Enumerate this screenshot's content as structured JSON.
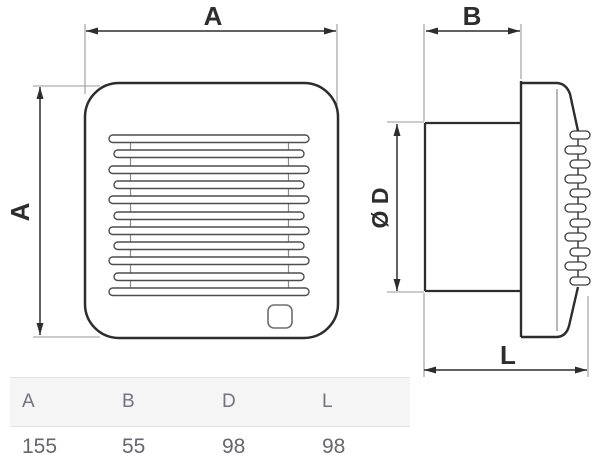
{
  "diagram": {
    "front_view": {
      "top_dim": "A",
      "left_dim": "A"
    },
    "side_view": {
      "top_dim": "B",
      "diameter_dim": "Ø D",
      "length_dim": "L"
    }
  },
  "table": {
    "headers": [
      "A",
      "B",
      "D",
      "L"
    ],
    "values": [
      "155",
      "55",
      "98",
      "98"
    ]
  },
  "colors": {
    "outline": "#2d2d2d",
    "thin_line": "#999999",
    "grille_stroke": "#4d4d4d",
    "table_header_bg": "#f5f5f6",
    "table_border": "#e4e4e6",
    "table_header_text": "#73737a",
    "table_value_text": "#66666b"
  }
}
